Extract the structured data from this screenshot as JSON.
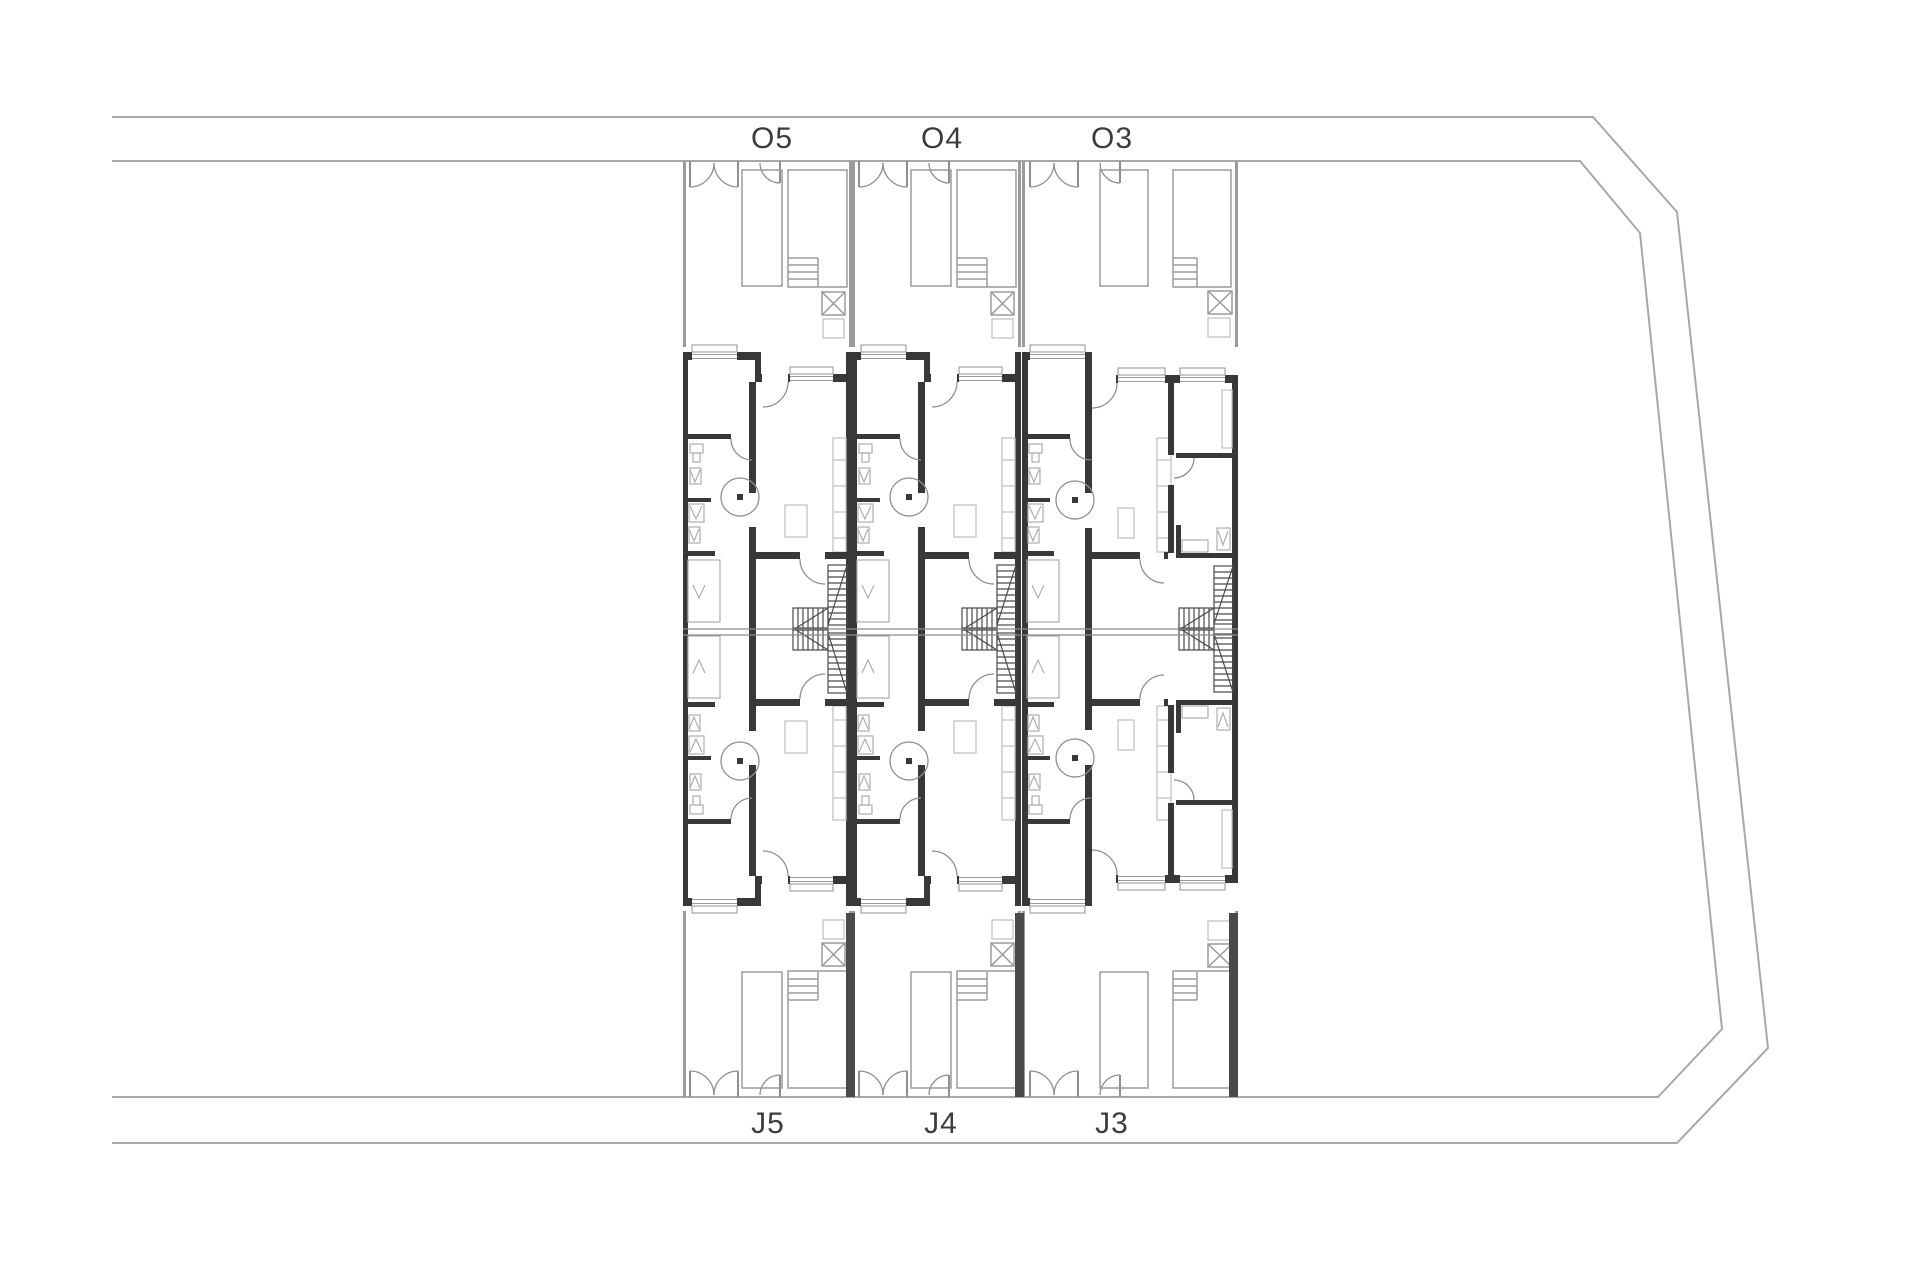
{
  "page": {
    "title": "Residential site floor plan",
    "background": "#ffffff"
  },
  "plan": {
    "type": "architectural-floor-plan",
    "units_top_row": [
      {
        "id": "O5",
        "label": "O5"
      },
      {
        "id": "O4",
        "label": "O4"
      },
      {
        "id": "O3",
        "label": "O3"
      }
    ],
    "units_bottom_row": [
      {
        "id": "J5",
        "label": "J5"
      },
      {
        "id": "J4",
        "label": "J4"
      },
      {
        "id": "J3",
        "label": "J3"
      }
    ],
    "colors": {
      "background": "#ffffff",
      "site_line": "#a8a8a8",
      "line_light": "#9b9b9b",
      "wall_dark": "#383838",
      "furniture": "#c2c2c2",
      "stair_line": "#4a4a4a",
      "label_text": "#3c3c3c"
    }
  }
}
